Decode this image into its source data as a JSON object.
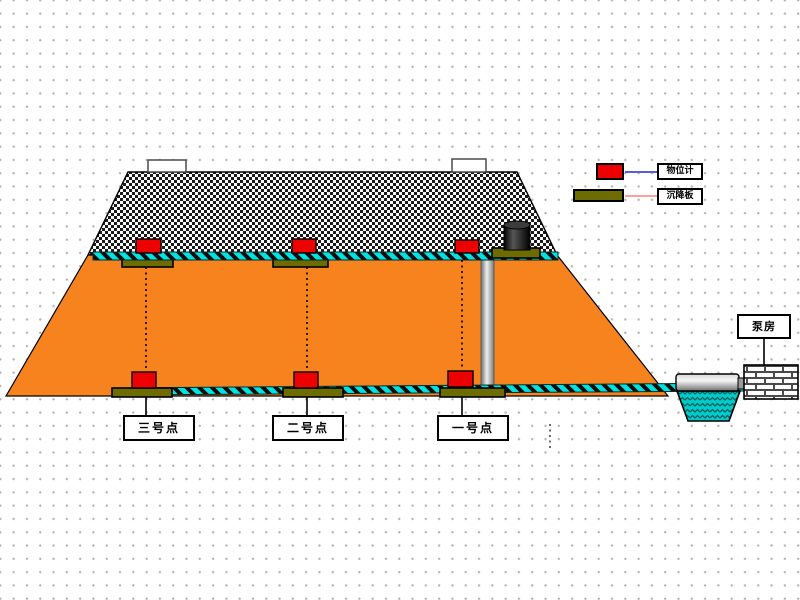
{
  "legend": {
    "items": [
      {
        "label": "物位计",
        "swatch_color": "#EC0000",
        "line_color": "#5C5CD6"
      },
      {
        "label": "沉降板",
        "swatch_color": "#6C6C00",
        "line_color": "#FF9E9E"
      }
    ]
  },
  "monitoring_points": [
    {
      "label": "三号点"
    },
    {
      "label": "二号点"
    },
    {
      "label": "一号点"
    }
  ],
  "pump_house_label": "泵房",
  "colors": {
    "dam_body_orange": "#F6831E",
    "rockfill_checker_black": "#1A1A1A",
    "gauge_red": "#EC0000",
    "plate_olive": "#6C6C00",
    "cable_cyan": "#00E2E2",
    "water_teal": "#00CCCC",
    "pipe_gray": "#9A9A9A"
  }
}
